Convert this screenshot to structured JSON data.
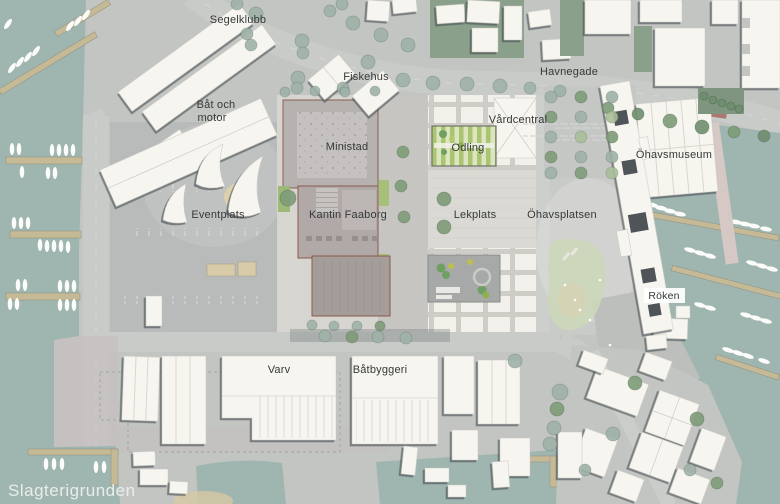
{
  "map": {
    "type": "architectural-site-plan",
    "region_labels": {
      "segelklubb": "Segelklubb",
      "fiskehus": "Fiskehus",
      "havnegade": "Havnegade",
      "bat_och_motor_line1": "Båt och",
      "bat_och_motor_line2": "motor",
      "ministad": "Ministad",
      "vardcentral": "Vårdcentral",
      "odling": "Odling",
      "ohavsmuseum": "Öhavsmuseum",
      "eventplats": "Eventplats",
      "kantin_faaborg": "Kantin Faaborg",
      "lekplats": "Lekplats",
      "ohavsplatsen": "Öhavsplatsen",
      "roken": "Röken",
      "varv": "Varv",
      "batbyggeri": "Båtbyggeri",
      "slagterigrunden": "Slagterigrunden"
    },
    "colors": {
      "water": "#9fb5b0",
      "land": "#c2c5c2",
      "road": "#c9cbc8",
      "building_white": "#f7f5f0",
      "building_shadow": "#4a5055",
      "pier_timber": "#c6b996",
      "site_building_gray": "#b5b1b0",
      "site_building_dark": "#a59d9a",
      "site_outline_brown": "#8a5b4c",
      "garden_green": "#a9c56f",
      "tree_green": "#7e9c78",
      "tree_gray_green": "#9fb2a8",
      "beach_green": "#ccd7b8",
      "label_text": "#353938",
      "water_label_text": "#e9edeb"
    }
  }
}
